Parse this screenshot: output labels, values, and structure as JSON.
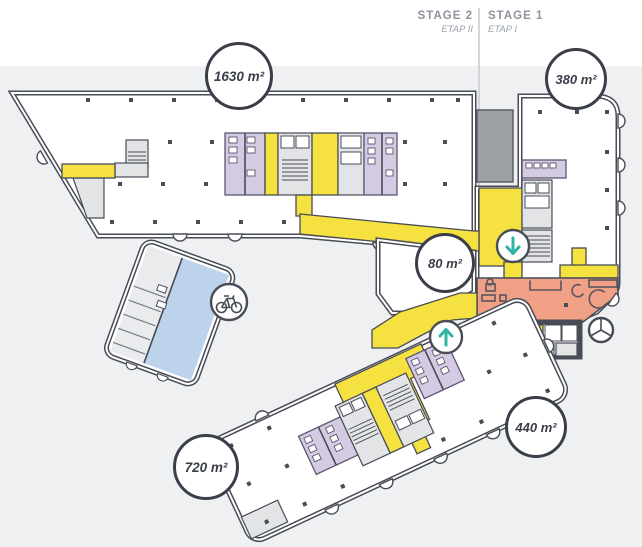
{
  "header": {
    "stages": [
      {
        "id": "stage-2",
        "label": "STAGE 2",
        "sublabel": "ETAP II"
      },
      {
        "id": "stage-1",
        "label": "STAGE 1",
        "sublabel": "ETAP I"
      }
    ]
  },
  "badges": [
    {
      "id": "area-stage2-upper-floor",
      "label": "1630 m²"
    },
    {
      "id": "area-stage1-upper-floor",
      "label": "380 m²"
    },
    {
      "id": "area-entrance-lobby",
      "label": "80 m²"
    },
    {
      "id": "area-stage1-lower-floor",
      "label": "440 m²"
    },
    {
      "id": "area-stage2-lower-floor",
      "label": "720 m²"
    }
  ],
  "icons": [
    {
      "name": "bicycle-icon",
      "meaning": "bicycle parking"
    },
    {
      "name": "arrow-down-icon",
      "meaning": "circulation direction down"
    },
    {
      "name": "arrow-up-icon",
      "meaning": "circulation direction up"
    }
  ],
  "colors": {
    "corridor_yellow": "#f5e13f",
    "reception_orange": "#f0a084",
    "room_purple": "#d4cbe3",
    "pool_blue": "#bdd3ec",
    "wall_ink": "#484c56",
    "shaft_gray": "#9da0a5",
    "floor_gray": "#e3e4e6",
    "background_gray": "#eff0f2",
    "arrow_teal": "#2eb5a3",
    "label_gray": "#8d939d"
  }
}
